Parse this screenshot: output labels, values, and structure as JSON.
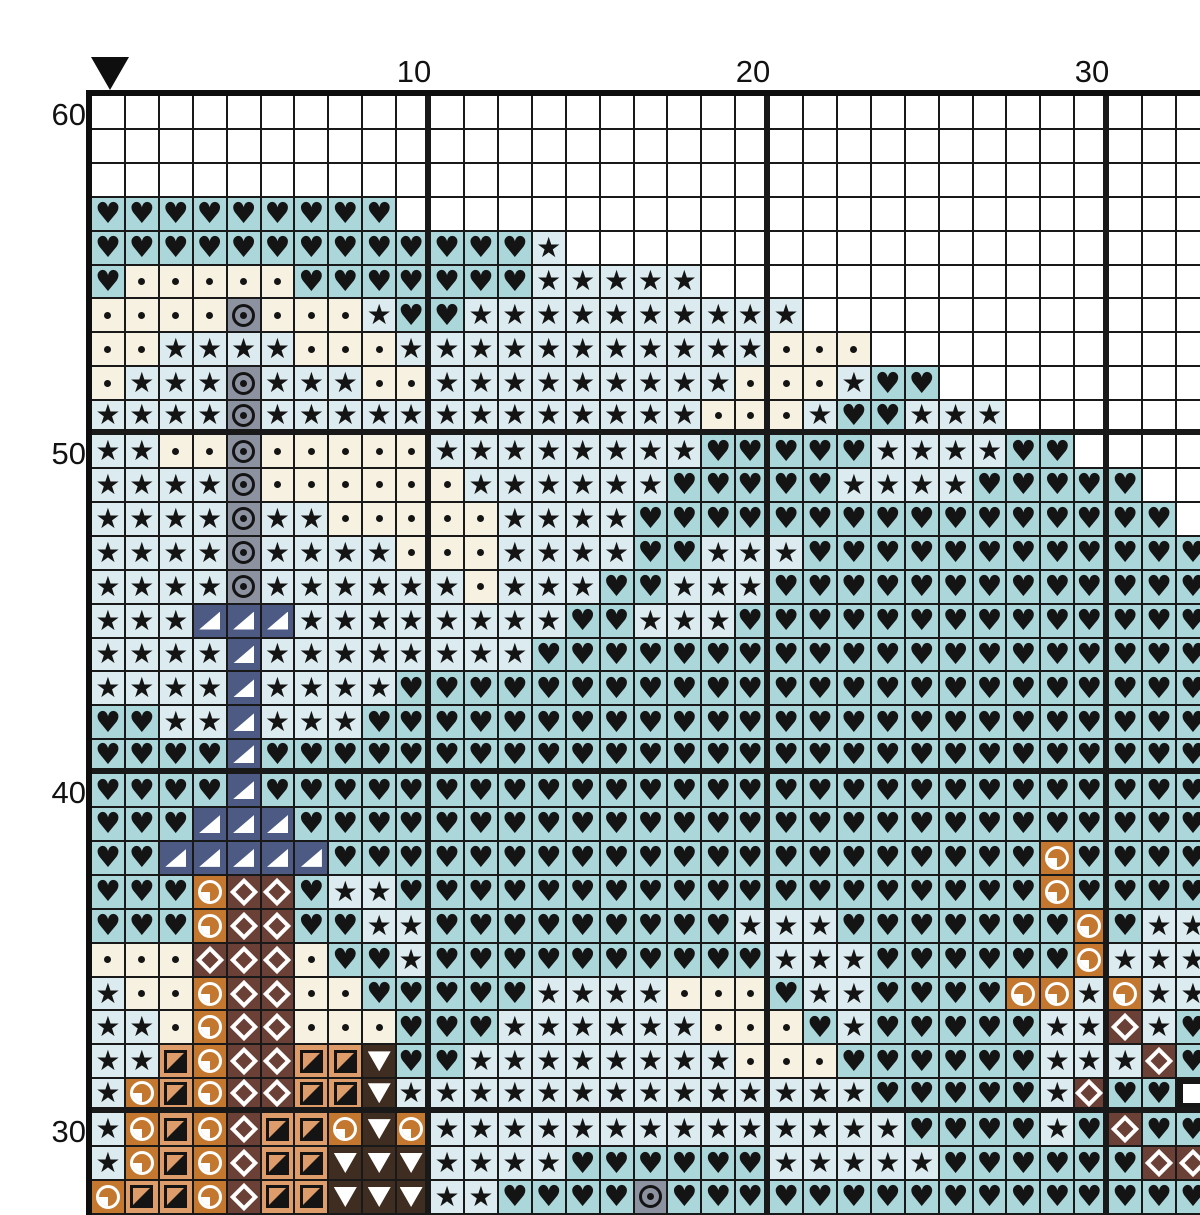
{
  "chart_title": "cross-stitch pattern grid",
  "axis": {
    "top_labels": [
      {
        "text": "10",
        "col": 10
      },
      {
        "text": "20",
        "col": 20
      },
      {
        "text": "30",
        "col": 30
      }
    ],
    "left_labels": [
      {
        "text": "60",
        "row": 60
      },
      {
        "text": "50",
        "row": 50
      },
      {
        "text": "40",
        "row": 40
      },
      {
        "text": "30",
        "row": 30
      }
    ]
  },
  "marker": {
    "name": "center-marker",
    "col": 1,
    "color": "#0e0e0e"
  },
  "colors": {
    "background": "#ffffff",
    "grid_line": "#191919",
    "thick_line": "#0e0e0e",
    "label_text": "#121212"
  },
  "palette": {
    ".": {
      "name": "empty",
      "bg": "#ffffff",
      "fg": "#141414",
      "symbol": "none"
    },
    "h": {
      "name": "black-heart",
      "bg": "#abd7db",
      "fg": "#141414",
      "symbol": "heart"
    },
    "s": {
      "name": "black-star",
      "bg": "#dcebef",
      "fg": "#141414",
      "symbol": "star"
    },
    "d": {
      "name": "black-dot",
      "bg": "#f6f1e1",
      "fg": "#141414",
      "symbol": "dot"
    },
    "o": {
      "name": "circled-dot",
      "bg": "#8c92a0",
      "fg": "#141414",
      "symbol": "circled-dot"
    },
    "t": {
      "name": "white-lower-right-triangle",
      "bg": "#4c5a84",
      "fg": "#ffffff",
      "symbol": "triangle-lr"
    },
    "q": {
      "name": "white-quarter-circle",
      "bg": "#c4772f",
      "fg": "#ffffff",
      "symbol": "quarter-circle"
    },
    "m": {
      "name": "white-diamond-outline",
      "bg": "#6b4036",
      "fg": "#ffffff",
      "symbol": "diamond"
    },
    "x": {
      "name": "black-half-square",
      "bg": "#dd9c69",
      "fg": "#141414",
      "symbol": "half-square"
    },
    "v": {
      "name": "white-down-triangle",
      "bg": "#3e2d20",
      "fg": "#ffffff",
      "symbol": "triangle-down"
    },
    "b": {
      "name": "white-square",
      "bg": "#161616",
      "fg": "#ffffff",
      "symbol": "square"
    }
  },
  "grid": {
    "columns": 33,
    "first_col": 1,
    "rows": [
      {
        "row": 60,
        "cells": "................................."
      },
      {
        "row": 59,
        "cells": "................................."
      },
      {
        "row": 58,
        "cells": "................................."
      },
      {
        "row": 57,
        "cells": "hhhhhhhhh........................"
      },
      {
        "row": 56,
        "cells": "hhhhhhhhhhhhhs..................."
      },
      {
        "row": 55,
        "cells": "hdddddhhhhhhhsssss..............."
      },
      {
        "row": 54,
        "cells": "ddddodddshhssssssssss............"
      },
      {
        "row": 53,
        "cells": "ddssssdddsssssssssssddd.........."
      },
      {
        "row": 52,
        "cells": "dsssosssddsssssssssdddshh........"
      },
      {
        "row": 51,
        "cells": "ssssosssssssssssssdddshhsss......"
      },
      {
        "row": 50,
        "cells": "ssddodddddsssssssshhhhhsssshh...."
      },
      {
        "row": 49,
        "cells": "ssssoddddddsssssshhhhhsssshhhhh.."
      },
      {
        "row": 48,
        "cells": "ssssossdddddsssshhhhhhhhhhhhhhhh."
      },
      {
        "row": 47,
        "cells": "ssssossssdddsssshhssshhhhhhhhhhhh"
      },
      {
        "row": 46,
        "cells": "ssssossssssdssshhssshhhhhhhhhhhhh"
      },
      {
        "row": 45,
        "cells": "ssstttsssssssshhssshhhhhhhhhhhhhh"
      },
      {
        "row": 44,
        "cells": "sssstsssssssshhhhhhhhhhhhhhhhhhhh"
      },
      {
        "row": 43,
        "cells": "sssstsssshhhhhhhhhhhhhhhhhhhhhhhh"
      },
      {
        "row": 42,
        "cells": "hhsstssshhhhhhhhhhhhhhhhhhhhhhhhh"
      },
      {
        "row": 41,
        "cells": "hhhhthhhhhhhhhhhhhhhhhhhhhhhhhhhh"
      },
      {
        "row": 40,
        "cells": "hhhhthhhhhhhhhhhhhhhhhhhhhhhhhhhh"
      },
      {
        "row": 39,
        "cells": "hhhttthhhhhhhhhhhhhhhhhhhhhhhhhhh"
      },
      {
        "row": 38,
        "cells": "hhttttthhhhhhhhhhhhhhhhhhhhhqhhhh"
      },
      {
        "row": 37,
        "cells": "hhhqmmhsshhhhhhhhhhhhhhhhhhhqhhhh"
      },
      {
        "row": 36,
        "cells": "hhhqmmhhsshhhhhhhhhssshhhhhhhqhss"
      },
      {
        "row": 35,
        "cells": "dddmmmdhhshhhhhhhhhhssshhhhhhqsss"
      },
      {
        "row": 34,
        "cells": "sddqmmddhhhhhssssdddhsshhhhqqsqss"
      },
      {
        "row": 33,
        "cells": "ssdqmmdddhhhssssssdddhshhhhhssmsh"
      },
      {
        "row": 32,
        "cells": "ssxqmmxxvhhssssssssdddhhhhhhsssmh"
      },
      {
        "row": 31,
        "cells": "sqxqmmxxvsssssssssssssshhhhhsmhhb"
      },
      {
        "row": 30,
        "cells": "sqxqmxxqvqsssssssssssssshhhhshmhh"
      },
      {
        "row": 29,
        "cells": "sqxqmxxvvvsssshhhhhhssssshhhhhhmm"
      },
      {
        "row": 28,
        "cells": "qxxqmxxvvvsshhhhohhhhhhhhhhhhhhhh"
      }
    ]
  }
}
